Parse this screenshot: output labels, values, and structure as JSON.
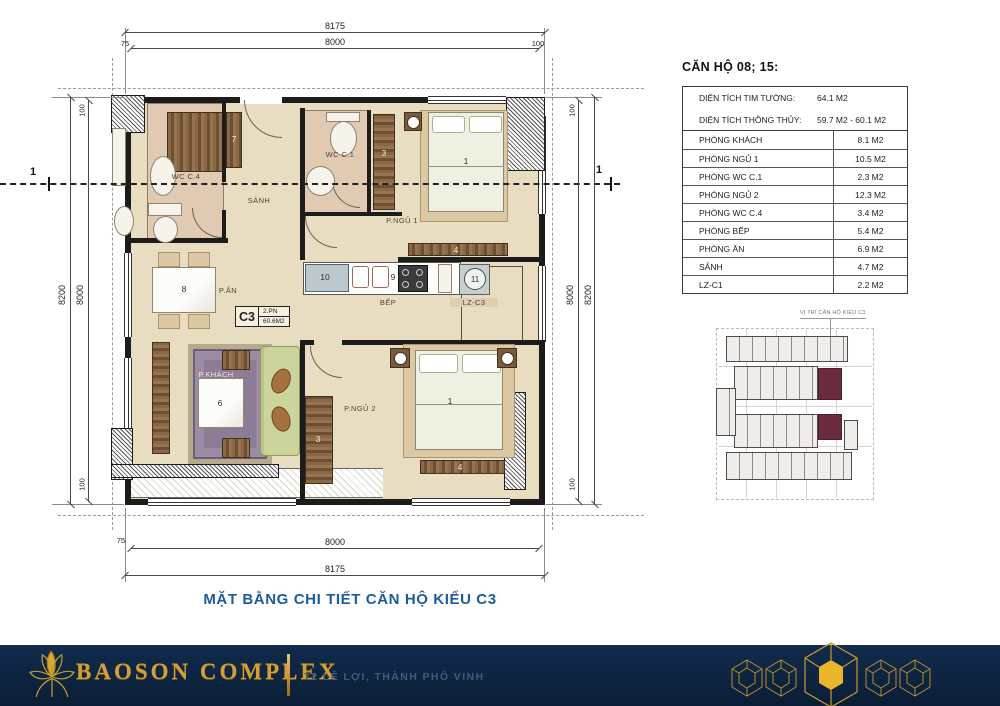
{
  "title": "MẶT BẰNG CHI TIẾT CĂN HỘ KIỂU C3",
  "info_panel": {
    "header": "CĂN HỘ 08; 15:",
    "summary": [
      {
        "label": "DIỆN TÍCH TIM TƯỜNG:",
        "value": "64.1 M2"
      },
      {
        "label": "DIỆN TÍCH THÔNG THỦY:",
        "value": "59.7 M2 - 60.1 M2"
      }
    ],
    "rooms": [
      {
        "label": "PHÒNG KHÁCH",
        "value": "8.1 M2"
      },
      {
        "label": "PHÒNG NGỦ 1",
        "value": "10.5 M2"
      },
      {
        "label": "PHÒNG WC C.1",
        "value": "2.3 M2"
      },
      {
        "label": "PHÒNG NGỦ 2",
        "value": "12.3 M2"
      },
      {
        "label": "PHÒNG WC C.4",
        "value": "3.4 M2"
      },
      {
        "label": "PHÒNG BẾP",
        "value": "5.4 M2"
      },
      {
        "label": "PHÒNG ĂN",
        "value": "6.9 M2"
      },
      {
        "label": "SẢNH",
        "value": "4.7 M2"
      },
      {
        "label": "LZ-C1",
        "value": "2.2 M2"
      }
    ]
  },
  "plan": {
    "badge": {
      "code": "C3",
      "type": "2.PN",
      "area": "60.6M2"
    },
    "labels": {
      "wc_c4": "WC C.4",
      "sanh": "SẢNH",
      "wc_c1": "WC C.1",
      "p_ngu_1": "P.NGỦ 1",
      "p_an": "P.ĂN",
      "bep": "BẾP",
      "lz_c3": "LZ-C3",
      "p_khach": "P.KHÁCH",
      "p_ngu_2": "P.NGỦ 2"
    },
    "numbers": {
      "bed": "1",
      "wardrobe": "3",
      "dresser": "4",
      "coffee_table": "6",
      "closet": "7",
      "dining_table": "8",
      "stove": "9",
      "kitchen_cabinet": "10",
      "washer": "11"
    },
    "dimensions": {
      "top_outer": "8175",
      "top_inner": "8000",
      "bottom_inner": "8000",
      "bottom_outer": "8175",
      "side_outer": "8200",
      "side_inner": "8000",
      "off_75": "75",
      "off_100": "100"
    },
    "section_marker": "1"
  },
  "minimap": {
    "caption": "VỊ TRÍ CĂN HỘ KIỂU C3"
  },
  "footer": {
    "brand": "BAOSON COMPLEX",
    "address": "72 LÊ LỢI, THÀNH PHỐ VINH"
  },
  "colors": {
    "accent_blue": "#1c5c9c",
    "footer_navy": "#0d2440",
    "gold": "#d3a035",
    "highlight_maroon": "#6b2d3d",
    "floor_beige": "#e9ddc1"
  }
}
